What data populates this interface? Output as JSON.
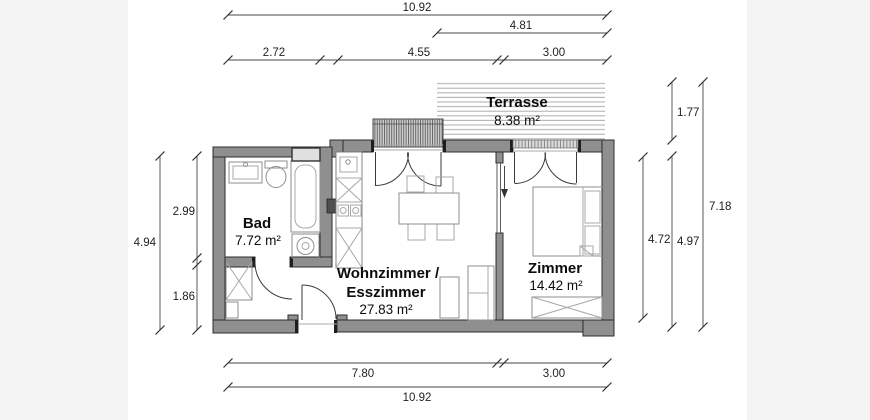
{
  "plan": {
    "rooms": {
      "terrasse": {
        "name": "Terrasse",
        "area": "8.38 m²"
      },
      "bad": {
        "name": "Bad",
        "area": "7.72 m²"
      },
      "wohnzimmer": {
        "name": "Wohnzimmer /",
        "name2": "Esszimmer",
        "area": "27.83 m²"
      },
      "zimmer": {
        "name": "Zimmer",
        "area": "14.42 m²"
      }
    },
    "dimensions": {
      "top_total": "10.92",
      "top_partial": "4.81",
      "top_seg1": "2.72",
      "top_seg2": "4.55",
      "top_seg3": "3.00",
      "bottom_seg1": "7.80",
      "bottom_seg2": "3.00",
      "bottom_total": "10.92",
      "left_total": "4.94",
      "left_seg1": "2.99",
      "left_seg2": "1.86",
      "right_room": "4.72",
      "right_terrace": "1.77",
      "right_inner": "4.97",
      "right_total": "7.18"
    },
    "colors": {
      "wall": "#8f8f8f",
      "outline": "#2e2e2e",
      "paper": "#ffffff",
      "background": "#f4f4f4",
      "hatch": "#b4b4b4"
    }
  }
}
